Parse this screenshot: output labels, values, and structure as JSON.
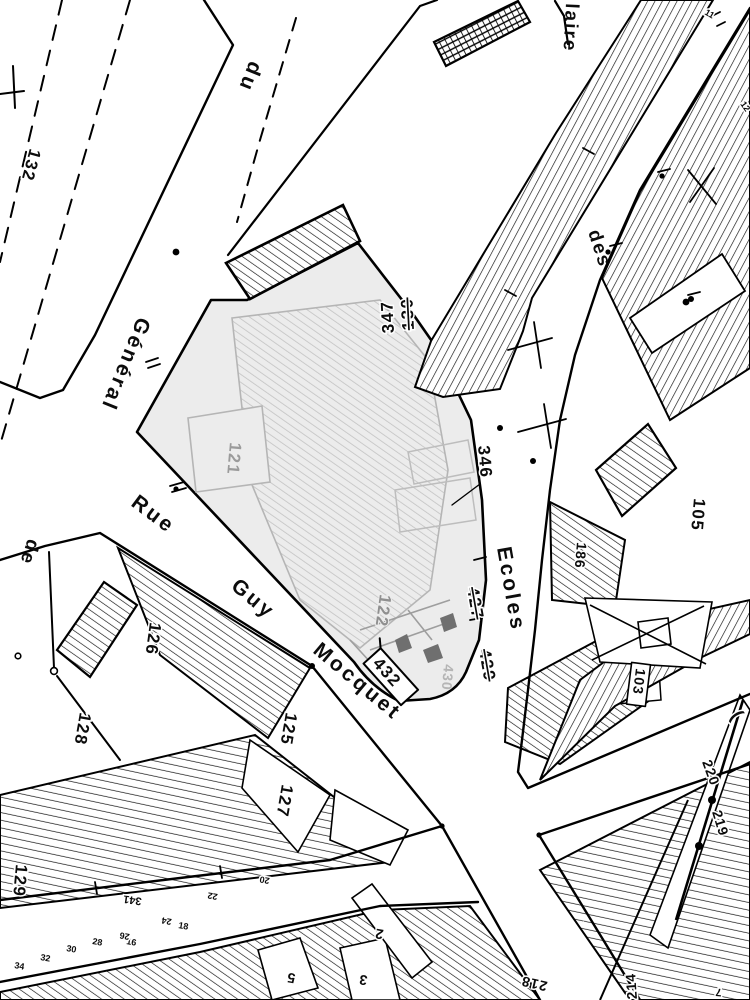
{
  "map": {
    "type": "scanned cadastral parcel map",
    "colors": {
      "ink": "#0c0c0c",
      "paper": "#ffffff",
      "highlight_wash": "#ececec",
      "faded_gray_hatch": "#c2c2c2",
      "faded_gray_text": "#9b9b9b"
    },
    "streets": {
      "du": "du",
      "general": "Général",
      "de": "de",
      "rue": "Rue",
      "guy": "Guy",
      "mocquet": "Mocquet",
      "des": "des",
      "ecoles": "Ecoles",
      "laire": "laire"
    },
    "parcels": {
      "p132": "132",
      "p130": "130",
      "p347": "347",
      "p346": "346",
      "p121": "121",
      "p122": "122",
      "p126": "126",
      "p128": "128",
      "p125": "125",
      "p127": "127",
      "p129": "129",
      "p427": "427",
      "p429": "429",
      "p430": "430",
      "p432": "432",
      "p105": "105",
      "p186": "186",
      "p103": "103",
      "p220": "220",
      "p219": "219",
      "p218": "218",
      "p214": "214"
    },
    "house_numbers": {
      "h341": "341",
      "h34": "34",
      "h32": "32",
      "h30": "30",
      "h28": "28",
      "h26": "26",
      "h24": "24",
      "h22": "22",
      "h20": "20",
      "h18": "18",
      "h16": "16",
      "h12": "12",
      "h11": "11",
      "n7": "7",
      "n5": "5",
      "n3": "3",
      "n2": "2",
      "paren": "("
    },
    "annotations": {
      "struck_out_numbers": [
        "130",
        "427",
        "429"
      ],
      "boxed_numbers": [
        "432",
        "103"
      ],
      "faded_highlighted_parcels": [
        "121",
        "122",
        "430"
      ]
    }
  }
}
